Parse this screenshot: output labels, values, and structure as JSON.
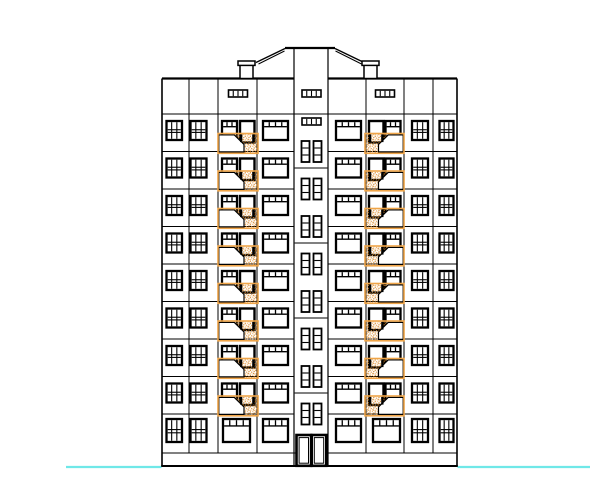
{
  "meta": {
    "drawing_type": "cad-architectural-elevation",
    "description": "Front elevation drawing of a nine-storey apartment building with two balcony bays, central stairwell core, attic vents, chimneys, entrance door and ground line"
  },
  "canvas": {
    "width": 601,
    "height": 500,
    "background": "#ffffff"
  },
  "colors": {
    "line": "#000000",
    "fill": "#ffffff",
    "balcony_frame": "#EFA549",
    "hatch_dot_dark": "#D2801F",
    "hatch_dot_mid": "#DF9136",
    "hatch_dot_light": "#F2B061",
    "ground_line": "#6FE8E8"
  },
  "building": {
    "left": 162,
    "right": 457,
    "parapet_y": 78.5,
    "attic_bottom_y": 114,
    "floor_height": 37.5,
    "upper_floor_count": 8,
    "ground_floor_top_y": 414,
    "base_line_y": 453,
    "bottom_y": 466,
    "interior_column_xs": [
      189,
      218,
      257,
      366,
      404,
      433
    ],
    "stair_bay": {
      "left": 294,
      "right": 328,
      "top_y": 48.5,
      "bottom_y": 466,
      "landing_line_ys": [
        168,
        243,
        318,
        393
      ]
    },
    "roof": {
      "flat_y": 48,
      "flat_x1": 285,
      "flat_x2": 335,
      "slopes": [
        {
          "x1": 285,
          "y1": 48.5,
          "x2": 256,
          "y2": 62.5
        },
        {
          "x1": 335,
          "y1": 48.5,
          "x2": 364,
          "y2": 62.5
        }
      ],
      "slopes_inner": [
        {
          "x1": 284.5,
          "y1": 51,
          "x2": 258.5,
          "y2": 64
        },
        {
          "x1": 335.5,
          "y1": 51,
          "x2": 361.5,
          "y2": 64
        }
      ],
      "chimneys": [
        {
          "body_x": 240,
          "body_w": 13,
          "cap_x": 238,
          "cap_w": 17
        },
        {
          "body_x": 364,
          "body_w": 13,
          "cap_x": 362,
          "cap_w": 17
        }
      ],
      "chimney_body_y": 65,
      "chimney_body_h": 13.5,
      "cap_y": 61,
      "cap_h": 4.4
    }
  },
  "vents": {
    "w": 19,
    "h": 7,
    "items": [
      {
        "x": 228.5,
        "y": 90
      },
      {
        "x": 302,
        "y": 90
      },
      {
        "x": 375.5,
        "y": 90
      },
      {
        "x": 302,
        "y": 118
      }
    ]
  },
  "stair_windows": {
    "xs": [
      301.5,
      313.5
    ],
    "w": 8,
    "h": 21,
    "center_ys": [
      151.5,
      189,
      226.5,
      264,
      301.5,
      339,
      376.5,
      414
    ]
  },
  "upper_windows": {
    "y_offset": 7,
    "h": 19,
    "door_h": 21.5,
    "columns": [
      {
        "x": 166.5,
        "w": 15.5,
        "type": "grid"
      },
      {
        "x": 190.5,
        "w": 16,
        "type": "grid"
      },
      {
        "x": 222,
        "w": 15,
        "type": "transom3"
      },
      {
        "x": 263,
        "w": 25,
        "type": "transom4"
      },
      {
        "x": 336,
        "w": 25,
        "type": "transom4"
      },
      {
        "x": 385.5,
        "w": 15,
        "type": "transom3"
      },
      {
        "x": 412,
        "w": 16,
        "type": "grid"
      },
      {
        "x": 439.5,
        "w": 14,
        "type": "grid"
      }
    ],
    "balcony_doors": [
      {
        "x": 240,
        "w": 14.5
      },
      {
        "x": 369,
        "w": 14.5
      }
    ]
  },
  "ground_windows": {
    "y": 419,
    "h": 23,
    "columns": [
      {
        "x": 166.5,
        "w": 15.5,
        "type": "grid"
      },
      {
        "x": 190.5,
        "w": 16,
        "type": "grid"
      },
      {
        "x": 223,
        "w": 27,
        "type": "transom4"
      },
      {
        "x": 263,
        "w": 25,
        "type": "transom4"
      },
      {
        "x": 336,
        "w": 25,
        "type": "transom4"
      },
      {
        "x": 373,
        "w": 27,
        "type": "transom4"
      },
      {
        "x": 412,
        "w": 16,
        "type": "grid"
      },
      {
        "x": 439.5,
        "w": 14,
        "type": "grid"
      }
    ]
  },
  "balconies": {
    "y_offset": 19.5,
    "h": 19.8,
    "left": {
      "box_x": 218,
      "box_w": 40,
      "hatch": [
        [
          234,
          0.8
        ],
        [
          257.2,
          0.8
        ],
        [
          257.2,
          19.2
        ],
        [
          243.6,
          19.2
        ],
        [
          243.6,
          10.2
        ]
      ],
      "panel": [
        [
          218.8,
          1.4
        ],
        [
          234.3,
          1.4
        ],
        [
          244,
          11
        ],
        [
          244,
          18.4
        ],
        [
          218.8,
          18.4
        ]
      ],
      "door_stubs": [
        240,
        252.2
      ],
      "stub_w": 2.3,
      "stub_h": 7.8
    },
    "right": {
      "box_x": 365,
      "box_w": 39,
      "hatch": [
        [
          365.8,
          0.8
        ],
        [
          388.5,
          0.8
        ],
        [
          378.9,
          10.2
        ],
        [
          378.9,
          19.2
        ],
        [
          365.8,
          19.2
        ]
      ],
      "panel": [
        [
          388.2,
          1.4
        ],
        [
          403.2,
          1.4
        ],
        [
          403.2,
          18.4
        ],
        [
          378.5,
          18.4
        ],
        [
          378.5,
          11
        ]
      ],
      "door_stubs": [
        369,
        381.2
      ],
      "stub_w": 2.3,
      "stub_h": 7.8
    }
  },
  "entrance": {
    "leaves": [
      {
        "x": 296.5
      },
      {
        "x": 311.7
      }
    ],
    "leaf_w": 14.6,
    "y": 435,
    "h": 30.8
  },
  "ground_line": {
    "y": 467,
    "width": 2.2,
    "segments": [
      [
        66,
        161.5
      ],
      [
        457.5,
        590
      ]
    ]
  }
}
